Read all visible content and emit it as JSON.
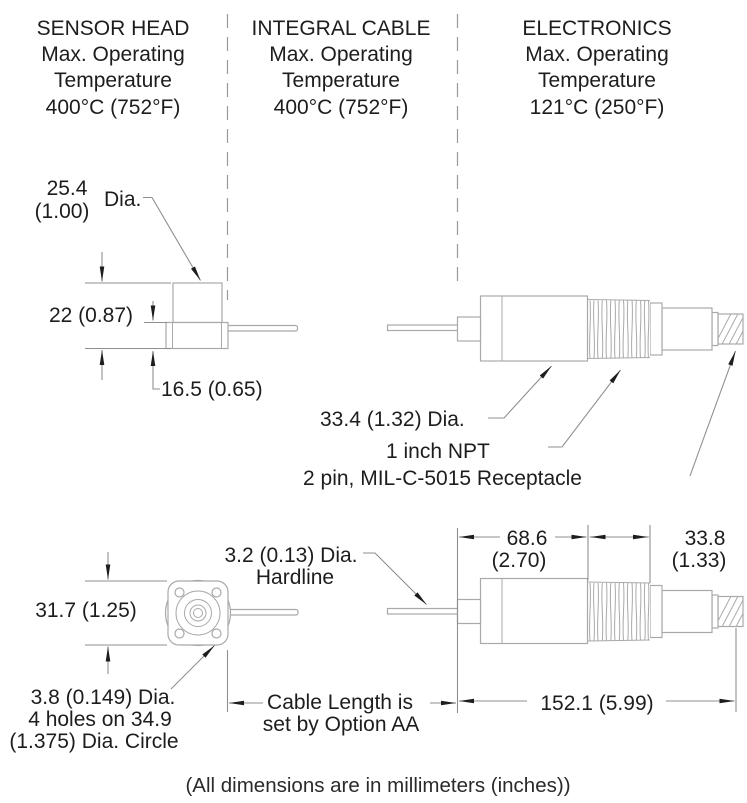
{
  "colors": {
    "background": "#ffffff",
    "drawing_line": "#a9a9a9",
    "dimension_line": "#8f8f8f",
    "text": "#1d1d1f"
  },
  "columns": [
    {
      "name": "SENSOR HEAD",
      "l2": "Max. Operating",
      "l3": "Temperature",
      "l4": "400°C (752°F)"
    },
    {
      "name": "INTEGRAL CABLE",
      "l2": "Max. Operating",
      "l3": "Temperature",
      "l4": "400°C (752°F)"
    },
    {
      "name": "ELECTRONICS",
      "l2": "Max. Operating",
      "l3": "Temperature",
      "l4": "121°C (250°F)"
    }
  ],
  "dimensions": {
    "head_dia_mm": "25.4",
    "head_dia_in": "(1.00)",
    "dia_label": "Dia.",
    "head_height": "22 (0.87)",
    "base_height": "16.5 (0.65)",
    "body_dia": "33.4 (1.32) Dia.",
    "thread": "1 inch NPT",
    "receptacle": "2 pin, MIL-C-5015 Receptacle",
    "flange_width": "31.7 (1.25)",
    "holes_l1": "3.8 (0.149) Dia.",
    "holes_l2": "4 holes on 34.9",
    "holes_l3": "(1.375) Dia. Circle",
    "hardline_l1": "3.2 (0.13) Dia.",
    "hardline_l2": "Hardline",
    "cable_l1": "Cable Length is",
    "cable_l2": "set by Option AA",
    "electronics_len_mm": "68.6",
    "electronics_len_in": "(2.70)",
    "thread_len_mm": "33.8",
    "thread_len_in": "(1.33)",
    "overall_len": "152.1 (5.99)"
  },
  "footer": "(All dimensions are in millimeters (inches))"
}
